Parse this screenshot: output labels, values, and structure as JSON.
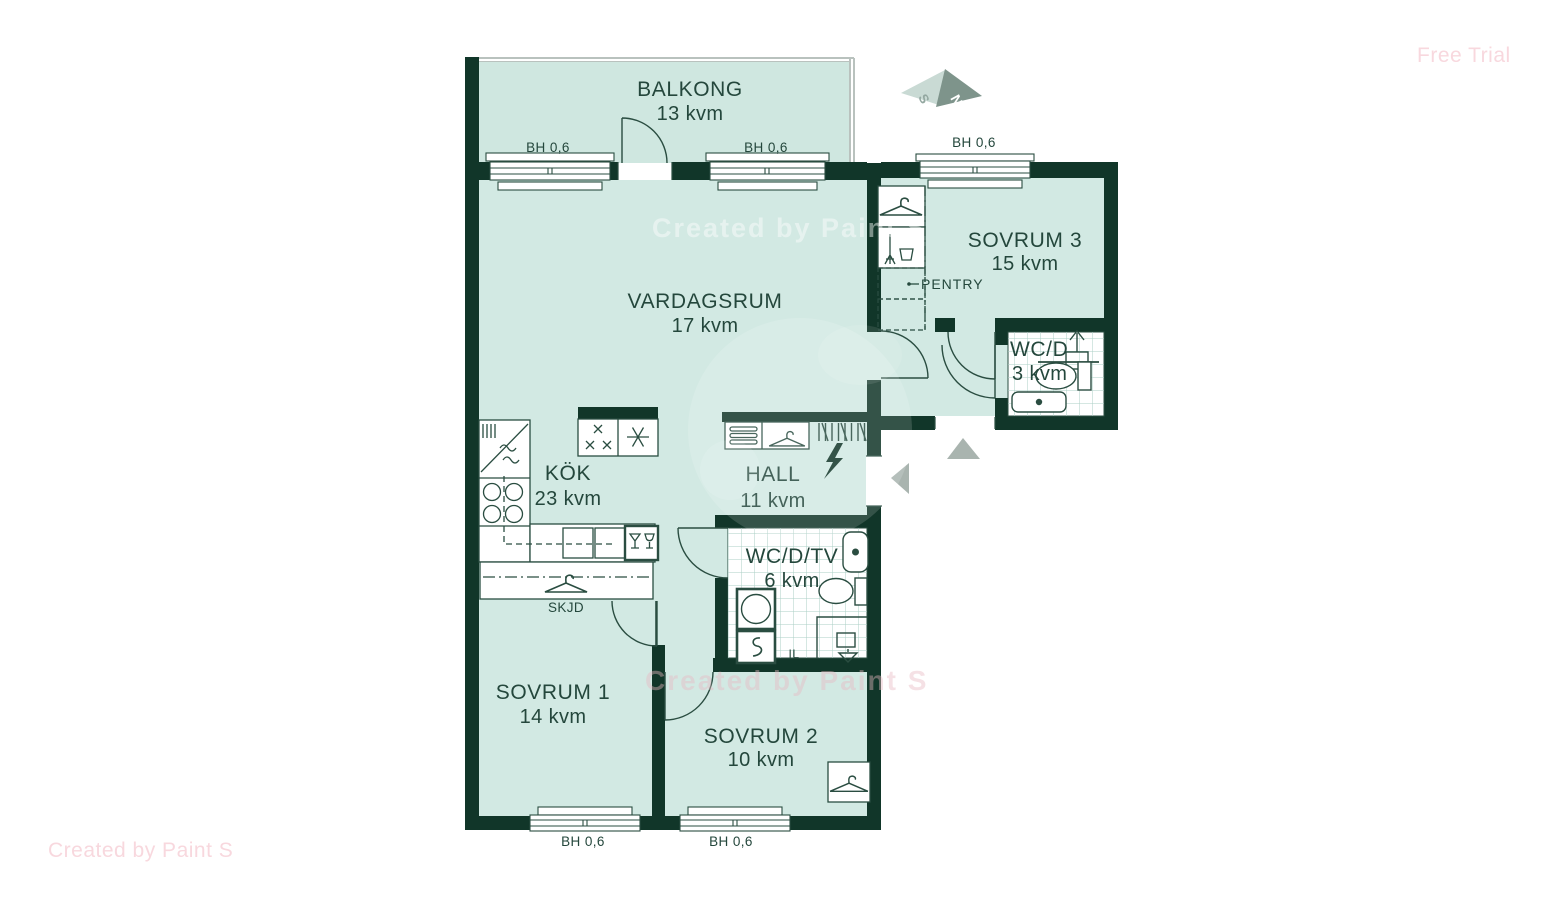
{
  "watermarks": {
    "free_trial": "Free Trial",
    "bottom_left": "Created by Paint S",
    "center_top": "Created by Paint S",
    "center_bottom": "Created by Paint S"
  },
  "compass": {
    "south": "S",
    "north": "N"
  },
  "rooms": {
    "balkong": {
      "name": "BALKONG",
      "area": "13 kvm"
    },
    "vardagsrum": {
      "name": "VARDAGSRUM",
      "area": "17 kvm"
    },
    "sovrum3": {
      "name": "SOVRUM 3",
      "area": "15 kvm"
    },
    "wcd": {
      "name": "WC/D",
      "area": "3 kvm"
    },
    "kok": {
      "name": "KÖK",
      "area": "23 kvm"
    },
    "hall": {
      "name": "HALL",
      "area": "11 kvm"
    },
    "wcdtv": {
      "name": "WC/D/TV",
      "area": "6 kvm"
    },
    "sovrum1": {
      "name": "SOVRUM 1",
      "area": "14 kvm"
    },
    "sovrum2": {
      "name": "SOVRUM 2",
      "area": "10 kvm"
    }
  },
  "annotations": {
    "pentry": "PENTRY",
    "skjd": "SKJD",
    "il": "IL"
  },
  "window_labels": [
    "BH 0,6",
    "BH 0,6",
    "BH 0,6",
    "BH 0,6",
    "BH 0,6"
  ],
  "colors": {
    "wall": "#113629",
    "room_fill": "#d2e9e3",
    "balcony_fill": "#cfe7e0",
    "outline": "#2a4d41",
    "tile_grid": "#abcfc6",
    "label_text": "#24473c",
    "watermark_pink": "#f8d8de",
    "arrow_gray": "#a9b4af",
    "compass_light": "#c9dad4",
    "compass_dark": "#7e948b"
  }
}
